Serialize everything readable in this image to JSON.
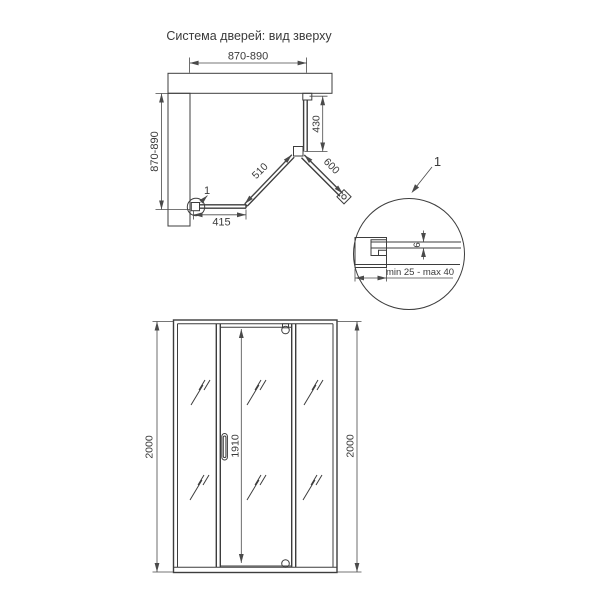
{
  "title": "Система дверей: вид зверху",
  "top_view": {
    "width_dim": "870-890",
    "depth_dim": "870-890",
    "side_panel_dim": "430",
    "fixed_panel_dim": "510",
    "door_dim": "600",
    "bottom_panel_dim": "415",
    "detail_marker_label": "1"
  },
  "detail_view": {
    "callout_label": "1",
    "glass_thickness_dim": "6",
    "adjustment_range_dim": "min 25 - max 40"
  },
  "front_view": {
    "height_left_dim": "2000",
    "height_right_dim": "2000",
    "door_height_dim": "1910"
  },
  "colors": {
    "line": "#3d3d3d",
    "dimension": "#4a4a4a",
    "text": "#3a3a3a",
    "background": "#ffffff"
  }
}
